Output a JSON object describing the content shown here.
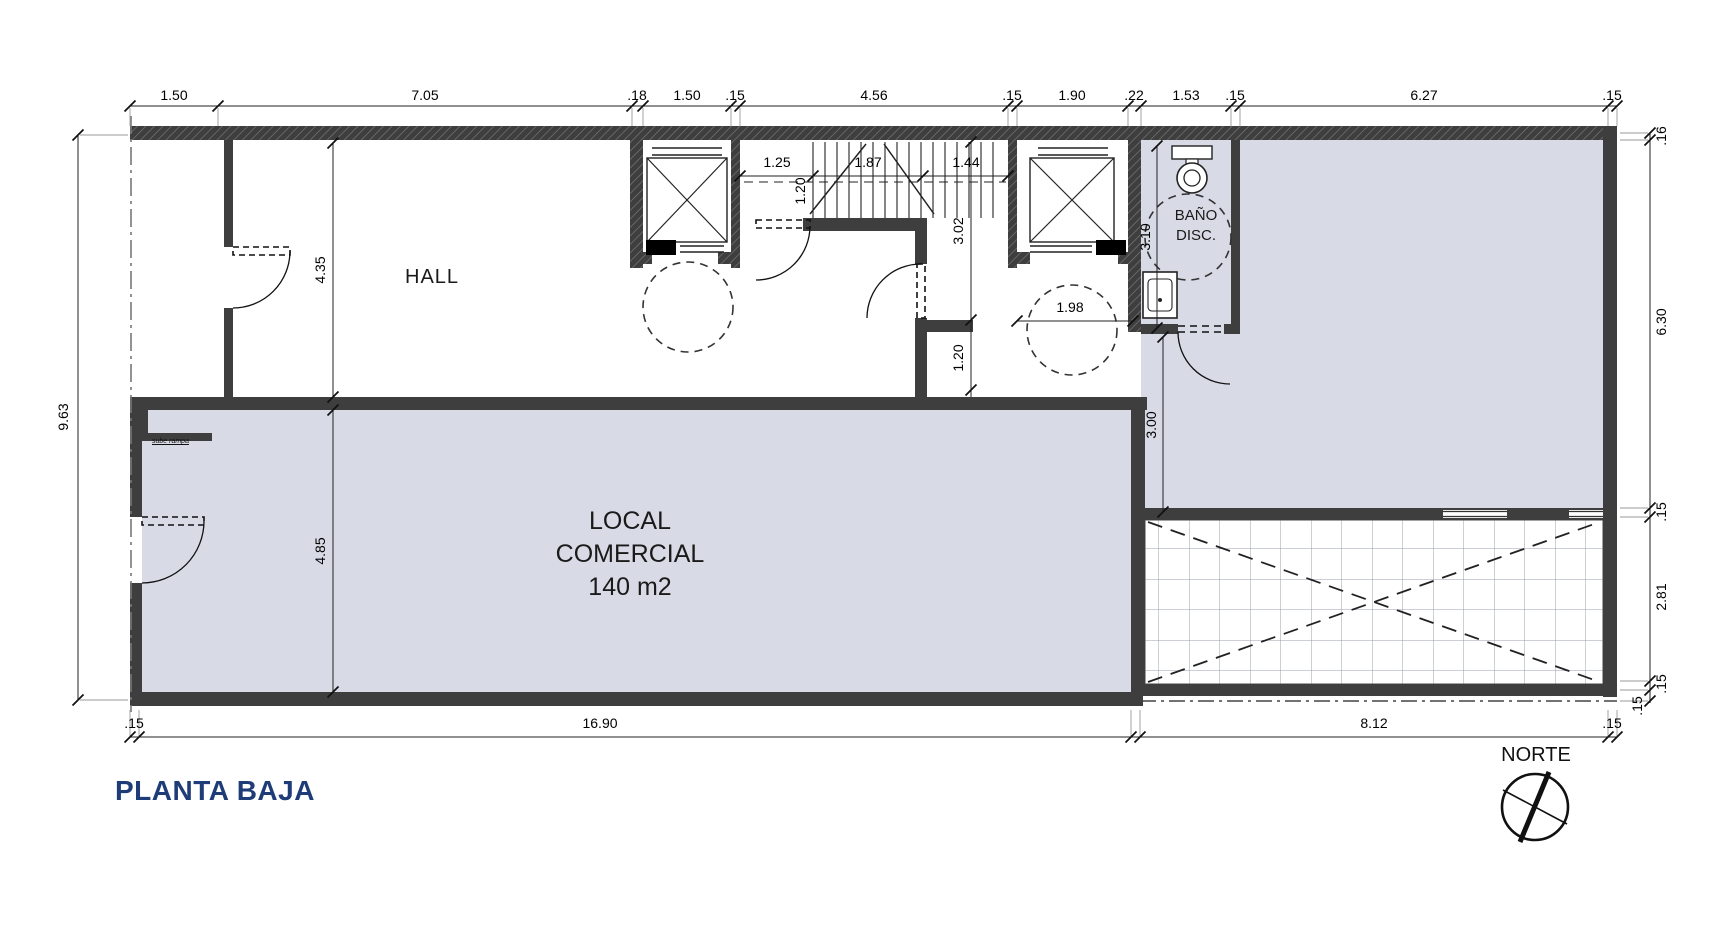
{
  "drawing_title": "PLANTA BAJA",
  "north_label": "NORTE",
  "rooms": {
    "hall": "HALL",
    "local_line1": "LOCAL",
    "local_line2": "COMERCIAL",
    "local_area": "140 m2",
    "bano_line1": "BAÑO",
    "bano_line2": "DISC.",
    "entry_note": "sube rampa"
  },
  "colors": {
    "floor_fill": "#d8dbe6",
    "wall": "#3e3e3e",
    "title_blue": "#1d3c78",
    "line": "#111111"
  },
  "dimensions_summary": {
    "top_chain": [
      "1.50",
      "7.05",
      ".18",
      "1.50",
      ".15",
      "4.56",
      ".15",
      "1.90",
      ".22",
      "1.53",
      ".15",
      "6.27",
      ".15"
    ],
    "left_chain": [
      "9.63"
    ],
    "right_chain": [
      ".16",
      "6.30",
      ".15",
      "2.81",
      ".15",
      ".15"
    ],
    "bottom_chain": [
      ".15",
      "16.90",
      "8.12",
      ".15"
    ],
    "interior": [
      "4.35",
      "4.85",
      "1.25",
      "1.20",
      "1.87",
      "1.44",
      "3.02",
      "1.20",
      "1.98",
      "3.10",
      "3.00"
    ]
  },
  "dim_labels": [
    {
      "t": "1.50",
      "x": 174,
      "y": 95
    },
    {
      "t": "7.05",
      "x": 425,
      "y": 95
    },
    {
      "t": ".18",
      "x": 637,
      "y": 95
    },
    {
      "t": "1.50",
      "x": 687,
      "y": 95
    },
    {
      "t": ".15",
      "x": 735,
      "y": 95
    },
    {
      "t": "4.56",
      "x": 874,
      "y": 95
    },
    {
      "t": ".15",
      "x": 1012,
      "y": 95
    },
    {
      "t": "1.90",
      "x": 1072,
      "y": 95
    },
    {
      "t": ".22",
      "x": 1134,
      "y": 95
    },
    {
      "t": "1.53",
      "x": 1186,
      "y": 95
    },
    {
      "t": ".15",
      "x": 1235,
      "y": 95
    },
    {
      "t": "6.27",
      "x": 1424,
      "y": 95
    },
    {
      "t": ".15",
      "x": 1612,
      "y": 95
    },
    {
      "t": "9.63",
      "x": 63,
      "y": 417,
      "rot": true
    },
    {
      "t": ".16",
      "x": 1661,
      "y": 136,
      "rot": true
    },
    {
      "t": "6.30",
      "x": 1661,
      "y": 322,
      "rot": true
    },
    {
      "t": ".15",
      "x": 1661,
      "y": 512,
      "rot": true
    },
    {
      "t": "2.81",
      "x": 1661,
      "y": 597,
      "rot": true
    },
    {
      "t": ".15",
      "x": 1661,
      "y": 684,
      "rot": true
    },
    {
      "t": ".15",
      "x": 1637,
      "y": 706,
      "rot": true
    },
    {
      "t": ".15",
      "x": 134,
      "y": 723
    },
    {
      "t": "16.90",
      "x": 600,
      "y": 723
    },
    {
      "t": "8.12",
      "x": 1374,
      "y": 723
    },
    {
      "t": ".15",
      "x": 1612,
      "y": 723
    },
    {
      "t": "4.35",
      "x": 320,
      "y": 270,
      "rot": true
    },
    {
      "t": "4.85",
      "x": 320,
      "y": 551,
      "rot": true
    },
    {
      "t": "1.25",
      "x": 777,
      "y": 162
    },
    {
      "t": "1.87",
      "x": 868,
      "y": 162
    },
    {
      "t": "1.44",
      "x": 966,
      "y": 162
    },
    {
      "t": "1.20",
      "x": 800,
      "y": 191,
      "rot": true
    },
    {
      "t": "3.02",
      "x": 958,
      "y": 231,
      "rot": true
    },
    {
      "t": "1.20",
      "x": 958,
      "y": 358,
      "rot": true
    },
    {
      "t": "1.98",
      "x": 1070,
      "y": 307
    },
    {
      "t": "3.10",
      "x": 1145,
      "y": 237,
      "rot": true
    },
    {
      "t": "3.00",
      "x": 1151,
      "y": 425,
      "rot": true
    }
  ]
}
